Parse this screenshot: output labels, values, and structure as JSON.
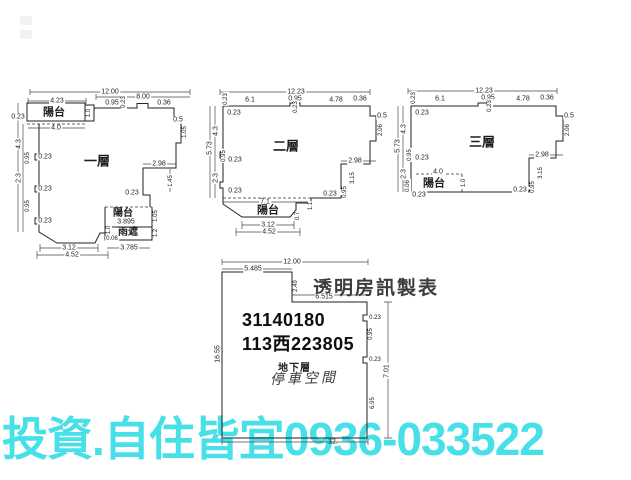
{
  "watermark": {
    "text": "投資.自住皆宜0936-033522",
    "color": "#48e0e8"
  },
  "basement": {
    "title": "透明房訊製表",
    "code_line1": "31140180",
    "code_line2": "113西223805",
    "floor_label": "地下層",
    "room_label": "停車空間"
  },
  "plans": {
    "floor1": {
      "name": "一層",
      "labels": [
        {
          "t": "12.00",
          "x": 98,
          "y": 6
        },
        {
          "t": "4.23",
          "x": 45,
          "y": 15
        },
        {
          "t": "8.00",
          "x": 131,
          "y": 11
        },
        {
          "t": "0.95",
          "x": 100,
          "y": 17
        },
        {
          "t": "0.23",
          "x": 112,
          "y": 16,
          "r": 1,
          "s": 6
        },
        {
          "t": "0.36",
          "x": 152,
          "y": 17
        },
        {
          "t": "陽台",
          "x": 42,
          "y": 27,
          "s": 11,
          "b": 1
        },
        {
          "t": "1.0",
          "x": 77,
          "y": 27,
          "r": 1,
          "s": 6
        },
        {
          "t": "0.23",
          "x": 6,
          "y": 31
        },
        {
          "t": "4.0",
          "x": 44,
          "y": 42
        },
        {
          "t": "0.5",
          "x": 166,
          "y": 34
        },
        {
          "t": "1.05",
          "x": 173,
          "y": 46,
          "r": 1,
          "s": 6
        },
        {
          "t": "4.3",
          "x": 7,
          "y": 58,
          "r": 1
        },
        {
          "t": "0.23",
          "x": 33,
          "y": 71
        },
        {
          "t": "0.95",
          "x": 16,
          "y": 72,
          "r": 1,
          "s": 6
        },
        {
          "t": "2.3",
          "x": 7,
          "y": 92,
          "r": 1
        },
        {
          "t": "0.23",
          "x": 33,
          "y": 103
        },
        {
          "t": "0.95",
          "x": 16,
          "y": 120,
          "r": 1,
          "s": 6
        },
        {
          "t": "0.23",
          "x": 33,
          "y": 135
        },
        {
          "t": "一層",
          "x": 85,
          "y": 75,
          "s": 13,
          "b": 1
        },
        {
          "t": "2.98",
          "x": 147,
          "y": 78
        },
        {
          "t": "1.45",
          "x": 159,
          "y": 95,
          "r": 1,
          "s": 6
        },
        {
          "t": "0.23",
          "x": 120,
          "y": 107
        },
        {
          "t": "陽台",
          "x": 111,
          "y": 128,
          "s": 10,
          "b": 1
        },
        {
          "t": "3.895",
          "x": 114,
          "y": 136
        },
        {
          "t": "1.05",
          "x": 144,
          "y": 130,
          "r": 1,
          "s": 6
        },
        {
          "t": "雨遮",
          "x": 116,
          "y": 147,
          "s": 10,
          "b": 1
        },
        {
          "t": "1.2",
          "x": 144,
          "y": 147,
          "r": 1,
          "s": 6
        },
        {
          "t": "1.0",
          "x": 97,
          "y": 144,
          "r": 1,
          "s": 6
        },
        {
          "t": "0.06",
          "x": 100,
          "y": 153,
          "s": 6
        },
        {
          "t": "3.12",
          "x": 57,
          "y": 162
        },
        {
          "t": "4.52",
          "x": 60,
          "y": 169
        },
        {
          "t": "3.785",
          "x": 117,
          "y": 162
        }
      ]
    },
    "floor2": {
      "name": "二層",
      "labels": [
        {
          "t": "12.23",
          "x": 88,
          "y": 6
        },
        {
          "t": "0.23",
          "x": 18,
          "y": 13,
          "r": 1,
          "s": 6
        },
        {
          "t": "6.1",
          "x": 42,
          "y": 14
        },
        {
          "t": "0.95",
          "x": 87,
          "y": 13
        },
        {
          "t": "0.23",
          "x": 88,
          "y": 21,
          "r": 1,
          "s": 6
        },
        {
          "t": "4.78",
          "x": 128,
          "y": 14
        },
        {
          "t": "0.36",
          "x": 152,
          "y": 13
        },
        {
          "t": "0.23",
          "x": 26,
          "y": 27
        },
        {
          "t": "4.3",
          "x": 8,
          "y": 45,
          "r": 1
        },
        {
          "t": "5.73",
          "x": 2,
          "y": 62,
          "r": 1
        },
        {
          "t": "0.95",
          "x": 16,
          "y": 70,
          "r": 1,
          "s": 6
        },
        {
          "t": "0.23",
          "x": 27,
          "y": 74
        },
        {
          "t": "2.3",
          "x": 8,
          "y": 92,
          "r": 1
        },
        {
          "t": "0.23",
          "x": 27,
          "y": 105
        },
        {
          "t": "二層",
          "x": 78,
          "y": 60,
          "s": 13,
          "b": 1
        },
        {
          "t": "0.5",
          "x": 174,
          "y": 30
        },
        {
          "t": "2.06",
          "x": 173,
          "y": 44,
          "r": 1,
          "s": 6
        },
        {
          "t": "2.98",
          "x": 147,
          "y": 75
        },
        {
          "t": "3.15",
          "x": 145,
          "y": 92,
          "r": 1,
          "s": 6
        },
        {
          "t": "0.95",
          "x": 137,
          "y": 106,
          "r": 1,
          "s": 6
        },
        {
          "t": "0.23",
          "x": 122,
          "y": 108
        },
        {
          "t": "7.1",
          "x": 57,
          "y": 116
        },
        {
          "t": "1.1",
          "x": 103,
          "y": 120,
          "r": 1,
          "s": 6
        },
        {
          "t": "陽台",
          "x": 60,
          "y": 125,
          "s": 11,
          "b": 1
        },
        {
          "t": "0.7",
          "x": 90,
          "y": 130,
          "r": 1,
          "s": 6
        },
        {
          "t": "3.12",
          "x": 60,
          "y": 139
        },
        {
          "t": "4.52",
          "x": 61,
          "y": 146
        }
      ]
    },
    "floor3": {
      "name": "三層",
      "labels": [
        {
          "t": "12.23",
          "x": 88,
          "y": 5
        },
        {
          "t": "0.23",
          "x": 18,
          "y": 12,
          "r": 1,
          "s": 6
        },
        {
          "t": "6.1",
          "x": 44,
          "y": 13
        },
        {
          "t": "0.95",
          "x": 92,
          "y": 12
        },
        {
          "t": "0.23",
          "x": 94,
          "y": 20,
          "r": 1,
          "s": 6
        },
        {
          "t": "4.78",
          "x": 127,
          "y": 13
        },
        {
          "t": "0.36",
          "x": 151,
          "y": 12
        },
        {
          "t": "0.23",
          "x": 26,
          "y": 27
        },
        {
          "t": "4.3",
          "x": 8,
          "y": 43,
          "r": 1
        },
        {
          "t": "5.73",
          "x": 2,
          "y": 60,
          "r": 1
        },
        {
          "t": "0.95",
          "x": 14,
          "y": 69,
          "r": 1,
          "s": 6
        },
        {
          "t": "0.23",
          "x": 26,
          "y": 72
        },
        {
          "t": "2.3",
          "x": 8,
          "y": 88,
          "r": 1
        },
        {
          "t": "三層",
          "x": 86,
          "y": 56,
          "s": 13,
          "b": 1
        },
        {
          "t": "0.5",
          "x": 173,
          "y": 30
        },
        {
          "t": "2.06",
          "x": 172,
          "y": 44,
          "r": 1,
          "s": 6
        },
        {
          "t": "2.98",
          "x": 146,
          "y": 69
        },
        {
          "t": "3.15",
          "x": 145,
          "y": 87,
          "r": 1,
          "s": 6
        },
        {
          "t": "0.95",
          "x": 137,
          "y": 101,
          "r": 1,
          "s": 6
        },
        {
          "t": "0.23",
          "x": 124,
          "y": 104
        },
        {
          "t": "4.0",
          "x": 42,
          "y": 86
        },
        {
          "t": "陽台",
          "x": 38,
          "y": 98,
          "s": 11,
          "b": 1
        },
        {
          "t": "1.0",
          "x": 68,
          "y": 97,
          "r": 1,
          "s": 6
        },
        {
          "t": "0.06",
          "x": 12,
          "y": 100,
          "r": 1,
          "s": 6
        },
        {
          "t": "0.23",
          "x": 23,
          "y": 109
        }
      ]
    },
    "basement": {
      "name": "地下層",
      "labels": [
        {
          "t": "12.00",
          "x": 74,
          "y": 6
        },
        {
          "t": "5.485",
          "x": 35,
          "y": 13
        },
        {
          "t": "2.49",
          "x": 78,
          "y": 30,
          "r": 1,
          "s": 6
        },
        {
          "t": "6.515",
          "x": 106,
          "y": 41
        },
        {
          "t": "16.55",
          "x": 0,
          "y": 98,
          "r": 1
        },
        {
          "t": "0.23",
          "x": 157,
          "y": 62,
          "s": 6
        },
        {
          "t": "0.95",
          "x": 153,
          "y": 78,
          "r": 1,
          "s": 6
        },
        {
          "t": "0.23",
          "x": 157,
          "y": 104,
          "s": 6
        },
        {
          "t": "7.01",
          "x": 169,
          "y": 115,
          "r": 1
        },
        {
          "t": "6.95",
          "x": 155,
          "y": 147,
          "r": 1,
          "s": 6
        },
        {
          "t": "12.",
          "x": 115,
          "y": 186,
          "nobg": 1
        }
      ]
    }
  }
}
